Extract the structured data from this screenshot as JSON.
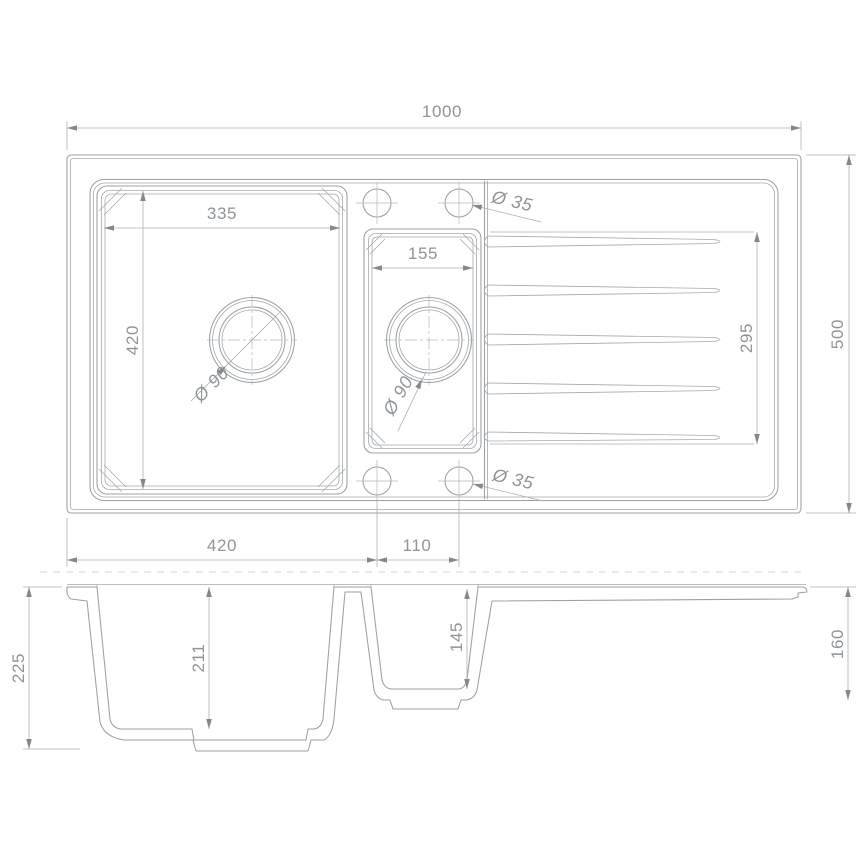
{
  "drawing": {
    "plan": {
      "overall_width": "1000",
      "overall_depth": "500",
      "main_bowl_width": "335",
      "main_bowl_length": "420",
      "small_bowl_width": "155",
      "drainer_length": "295",
      "tap_hole_top": "Ø 35",
      "tap_hole_bottom": "Ø 35",
      "main_drain": "Ø 90",
      "small_drain": "Ø 90",
      "edge_to_hole": "420",
      "hole_spacing": "110"
    },
    "section": {
      "overall_depth": "225",
      "main_bowl_depth": "211",
      "small_bowl_depth": "145",
      "drainer_end_depth": "160"
    }
  }
}
